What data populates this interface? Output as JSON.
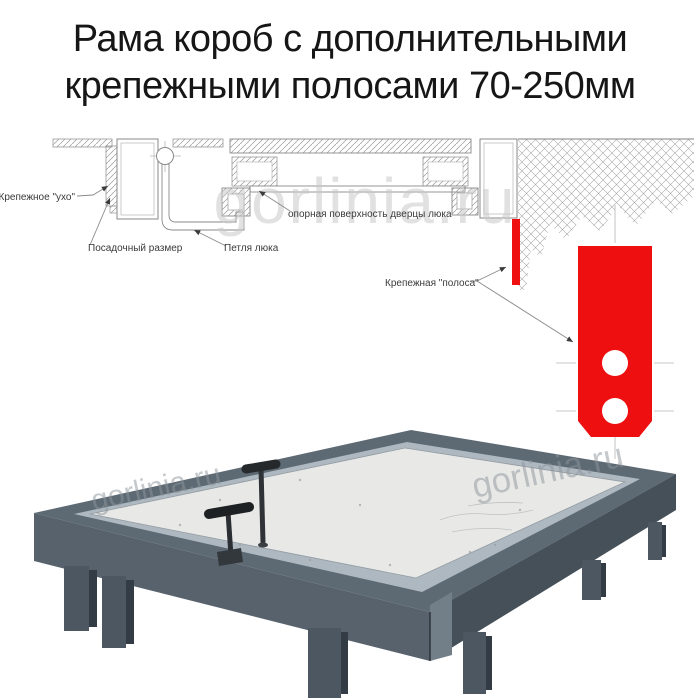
{
  "title": {
    "line1": "Рама короб с дополнительными",
    "line2": "крепежными полосами 70-250мм"
  },
  "watermark": {
    "text": "gorlinia.ru",
    "diagram_color": "#c9c9c9",
    "photo_color": "#8e959b"
  },
  "diagram": {
    "labels": {
      "mounting_ear": "Крепежное \"ухо\"",
      "seat_size": "Посадочный размер",
      "hatch_hinge": "Петля люка",
      "door_support_surface": "опорная поверхность дверцы люка",
      "mounting_strip": "Крепежная \"полоса\""
    },
    "colors": {
      "mounting_strip_red": "#ee1010",
      "drawing_line": "#8a8a8a"
    }
  },
  "photo": {
    "colors": {
      "frame_steel": "#5d6973",
      "frame_skirt": "#57626c",
      "panel": "#e8e9e6",
      "handle": "#26292c"
    }
  }
}
